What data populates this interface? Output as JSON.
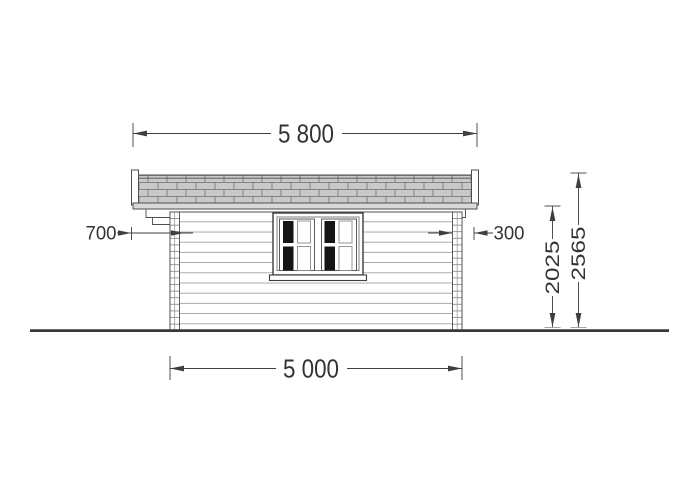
{
  "drawing": {
    "type": "log-cabin-side-elevation",
    "labels": {
      "roof_width": "5 800",
      "base_width": "5 000",
      "overhang_left": "700",
      "overhang_right": "300",
      "eave_height": "2025",
      "ridge_height": "2565"
    },
    "colors": {
      "line": "#4d4d4d",
      "dim_line": "#3f3f3f",
      "text": "#333333",
      "shingle_fill": "#c9c9c9",
      "shingle_line": "#7a7a7a",
      "fascia_fill": "#d9d9d9",
      "siding_line": "#8f8f8f",
      "glass_dark": "#151515",
      "ground": "#383838"
    }
  }
}
